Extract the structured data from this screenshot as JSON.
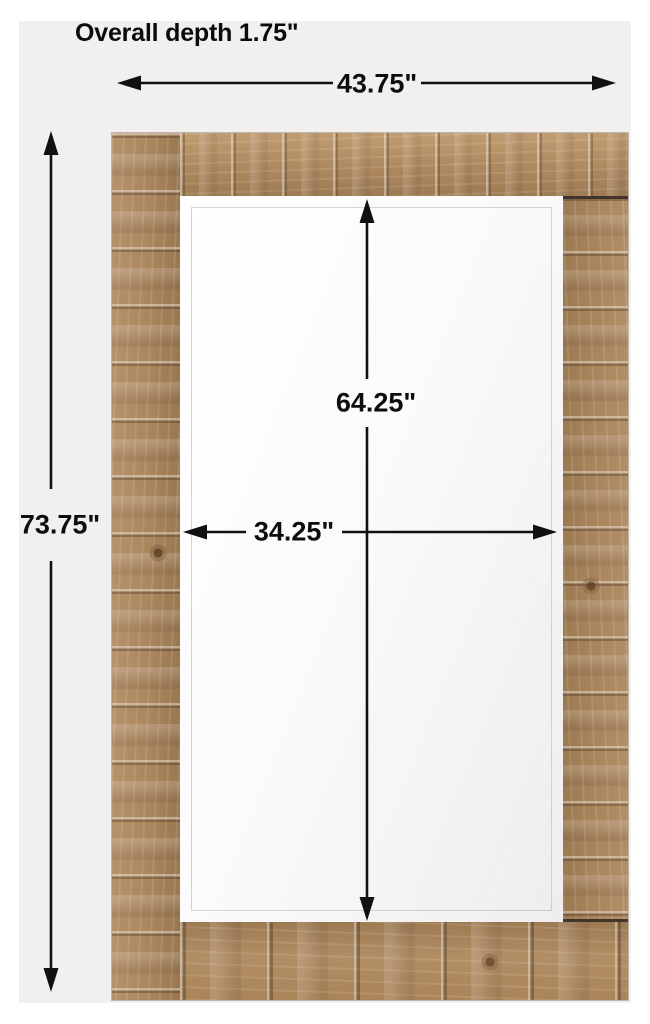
{
  "title": "Overall depth 1.75\"",
  "dimensions": {
    "overall_width": "43.75\"",
    "overall_height": "73.75\"",
    "mirror_height": "64.25\"",
    "mirror_width": "34.25\"",
    "overall_depth": "1.75\""
  },
  "colors": {
    "page-bg": "#ffffff",
    "panel-bg": "#f1f0ee",
    "line-color": "#111111",
    "wood-base": "#aa865e",
    "wood-seam": "#41342a",
    "mirror-glass": "#fbfbfb"
  }
}
